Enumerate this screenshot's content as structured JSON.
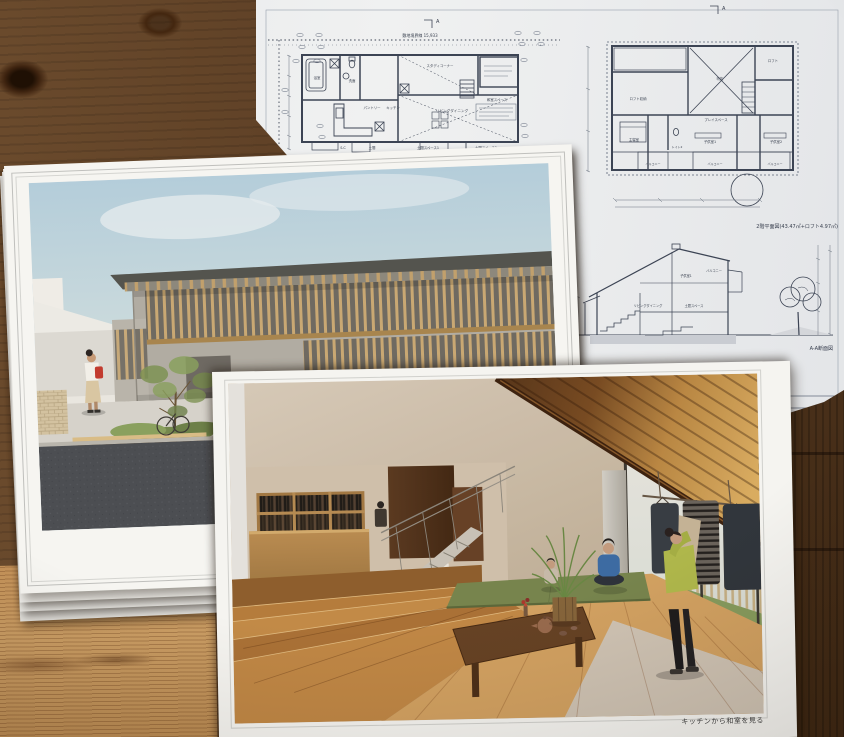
{
  "colors": {
    "table_wood": "#5d3f26",
    "paper": "#f4f3ef",
    "blueprint_line": "#39404f",
    "sky": "#b7cedb",
    "tatami_green": "#7c8a50",
    "red_bag": "#c23b2e"
  },
  "blueprint_sheet": {
    "site_boundary_label": "敷地境界線 15,933",
    "section_marker": "A",
    "floor1_rooms": [
      "浴室",
      "洗面",
      "スタディコーナー",
      "パントリー",
      "キッチン",
      "リビングダイニング",
      "和室スペース",
      "S.C",
      "土間",
      "土間スペース1",
      "土間スペース2"
    ],
    "floor2": {
      "caption": "2階平面図(43.47㎡+ロフト4.97㎡)",
      "rooms": [
        "ロフト収納",
        "主寝室",
        "プレイスペース",
        "子供室1",
        "子供室2",
        "ロフト",
        "吹抜",
        "トイレ2",
        "バルコニー"
      ]
    },
    "section": {
      "caption": "A-A断面図",
      "labels": [
        "子供室1",
        "バルコニー",
        "リビングダイニング",
        "土間スペース"
      ],
      "scale_label": "縮尺 1/50"
    }
  },
  "interior_sheet": {
    "caption": "キッチンから和室を見る"
  }
}
